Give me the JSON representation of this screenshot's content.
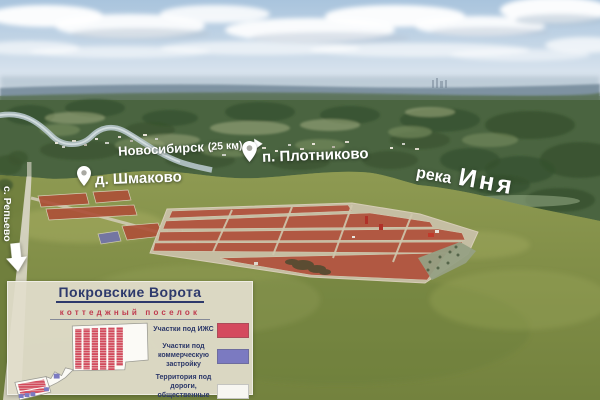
{
  "photo": {
    "labels": {
      "novosibirsk_city": "Новосибирск",
      "novosibirsk_distance": "(25 км)",
      "plotnikovo": "п. Плотниково",
      "shmakovo": "д. Шмаково",
      "river_word1": "река",
      "river_word2": "Иня",
      "road_destination": "с. Репьево"
    },
    "colors": {
      "parcel_overlay": "#b0503a",
      "road": "#d8d5c6"
    }
  },
  "legend": {
    "title": "Покровские Ворота",
    "subtitle": "коттеджный поселок",
    "items": [
      {
        "label": "Участки под ИЖС",
        "color": "#d44a5e"
      },
      {
        "label": "Участки под коммерческую застройку",
        "color": "#7b7ac1"
      },
      {
        "label": "Территория под дороги, общественные зоны",
        "color": "#f7f6f1"
      }
    ]
  }
}
